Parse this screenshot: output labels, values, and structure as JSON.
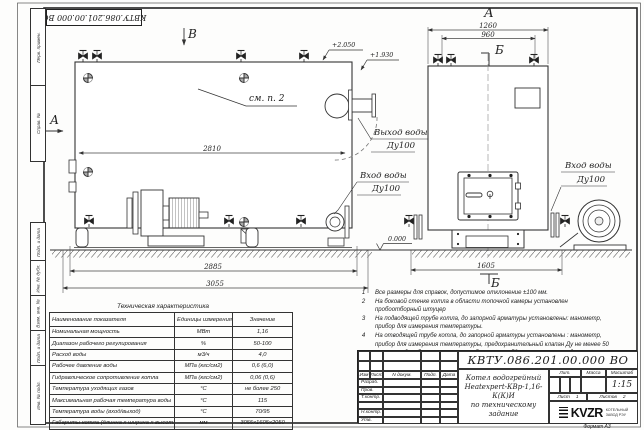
{
  "frame": {
    "left_labels": [
      "Перв. примен.",
      "Справ. №",
      "Подп. и дата",
      "Инв. № дубл.",
      "Взам. инв. №",
      "Подп. и дата",
      "Инв. № подл."
    ],
    "format_note": "Формат  А3"
  },
  "drawing": {
    "dims": {
      "body_length": "2810",
      "base_length": "2885",
      "overall_length": "3055",
      "front_width": "1260",
      "front_valves": "960",
      "front_base": "1605"
    },
    "letters": {
      "view_b": "В",
      "view_a_side": "А",
      "view_a_front": "А",
      "section_b_top": "Б",
      "section_b_bottom": "Б"
    },
    "see_ref": "см. п. 2",
    "elev": {
      "top": "+2.050",
      "outlet": "+1.930",
      "zero": "0.000"
    },
    "labels": {
      "outlet": "Выход воды",
      "outlet_dn": "Ду100",
      "inlet_side": "Вход воды",
      "inlet_side_dn": "Ду100",
      "inlet_front": "Вход воды",
      "inlet_front_dn": "Ду100"
    }
  },
  "notes": [
    {
      "num": "1",
      "text": "Все размеры для справок, допустимое отклонение  ±100 мм."
    },
    {
      "num": "2",
      "text": "На боковой стенке котла в области топочной камеры установлен пробоотборный штуцер"
    },
    {
      "num": "3",
      "text": "На  подводящей трубе котла, до запорной арматуры установлены: манометр, прибор для измерения температуры."
    },
    {
      "num": "4",
      "text": "На отводящей трубе котла, до запорной арматуры установлены : манометр, прибор для измерения температуры, предохранительный клапан  Ду не менее  50 мм и отвод с обратным клапаном  Ду не менее 50 мм, или не менее двух предохранительных клапанов  Ду не менее  50 мм ."
    }
  ],
  "tech_table": {
    "title": "Техническая характеристика",
    "headers": [
      "Наименование показателя",
      "Единицы измерения",
      "Значение"
    ],
    "rows": [
      [
        "Номинальная мощность",
        "МВт",
        "1,16"
      ],
      [
        "Диапазон рабочего регулирования",
        "%",
        "50-100"
      ],
      [
        "Расход воды",
        "м3/ч",
        "4,0"
      ],
      [
        "Рабочее давление воды",
        "МПа (кгс/см2)",
        "0,6 (6,0)"
      ],
      [
        "Гидравлическое сопротивление котла",
        "МПа (кгс/см2)",
        "0,06 (0,6)"
      ],
      [
        "Температура уходящих газов",
        "°С",
        "не более 250"
      ],
      [
        "Максимальная рабочая температура воды",
        "°С",
        "115"
      ],
      [
        "Температура воды (вход/выход)",
        "°С",
        "70/95"
      ],
      [
        "Габариты котла (длинна х ширина х высота)",
        "мм",
        "3055х1605х2050"
      ]
    ]
  },
  "title_block": {
    "doc_number": "КВТУ.086.201.00.000  ВО",
    "product_title_1": "Котел водогрейный",
    "product_title_2": "Heatexpert-КВр-1,16-К(К)И",
    "product_title_3": "по техническому задание",
    "cols": {
      "izm": "Изм",
      "list": "Лист",
      "doc": "N докум.",
      "podp": "Подп.",
      "data": "Дата"
    },
    "rows": [
      "Разраб.",
      "Пров.",
      "Т.контр.",
      "",
      "Н.контр.",
      "Утв."
    ],
    "lit": "Лит.",
    "mass": "Масса",
    "scale": "Масштаб",
    "scale_value": "1:15",
    "sheet_label": "Лист",
    "sheet_value": "1",
    "sheets_label": "Листов",
    "sheets_value": "2",
    "logo": "KVZR",
    "logo_line1": "КОТЕЛЬНЫЙ",
    "logo_line2": "ЗАВОД РЭУ"
  }
}
